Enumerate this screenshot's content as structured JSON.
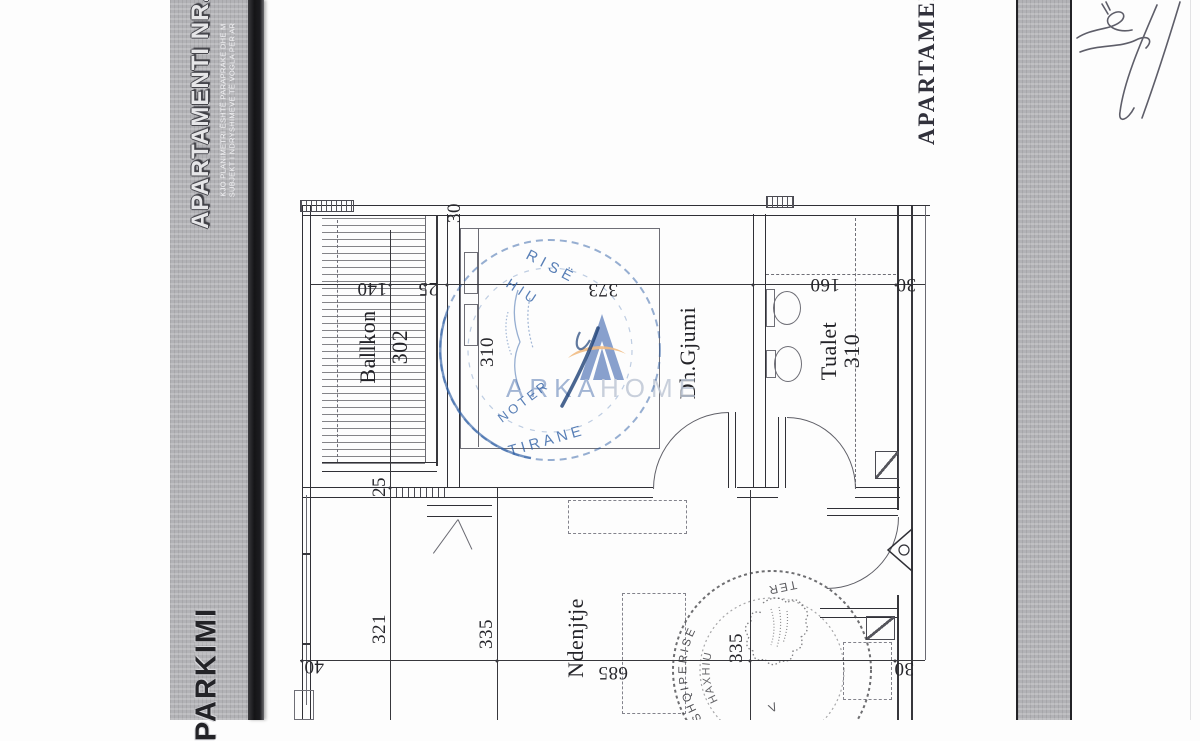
{
  "colors": {
    "band_grey": "#b2b2b6",
    "edge_dark": "#1a1a1d",
    "ink": "#2f2f33",
    "stamp_blue": "#3060a5",
    "stamp_grey": "#3d3d42",
    "logo_blue": "#7490c5",
    "logo_text_primary": "#93a9cd",
    "logo_text_secondary": "#bfc8d6",
    "logo_swoosh_orange": "#eeb06e"
  },
  "left_band": {
    "title": "APARTAMENTI NR.",
    "note_line1": "KJO PLANIMETRI ËSHTË PARAPRAKE DHE M",
    "note_line2": "SUBJEKT I NDRYSHIMEVE TË VOGLA PER AR",
    "bottom_label": "PARKIMI"
  },
  "right_band": {
    "title": "APARTAMENTI NR."
  },
  "plan": {
    "rooms": {
      "balcony": "Ballkon",
      "balcony_area": "302",
      "bedroom": "Dh.Gjumi",
      "toilet": "Tualet",
      "toilet_area": "310",
      "living": "Ndenjtje"
    },
    "dims": {
      "top_140": "140",
      "top_25": "25",
      "top_373": "373",
      "top_160": "160",
      "top_30": "30",
      "wall_30": "30",
      "bedroom_310": "310",
      "balcony_25": "25",
      "left_321": "321",
      "mid_335": "335",
      "right_335": "335",
      "bottom_40": "40",
      "bottom_685": "685",
      "bottom_30": "30"
    }
  },
  "watermark": {
    "brand_left": "ARKA",
    "brand_right": "HOME"
  },
  "stamps": {
    "blue": {
      "arc_top": "RISË",
      "name_fragment": "HIU",
      "role": "NOTER",
      "city": "TIRANE"
    },
    "grey": {
      "country": "SHQIPERISE",
      "name": "HAXHIU",
      "fragment": "TER",
      "initial": "V"
    }
  }
}
